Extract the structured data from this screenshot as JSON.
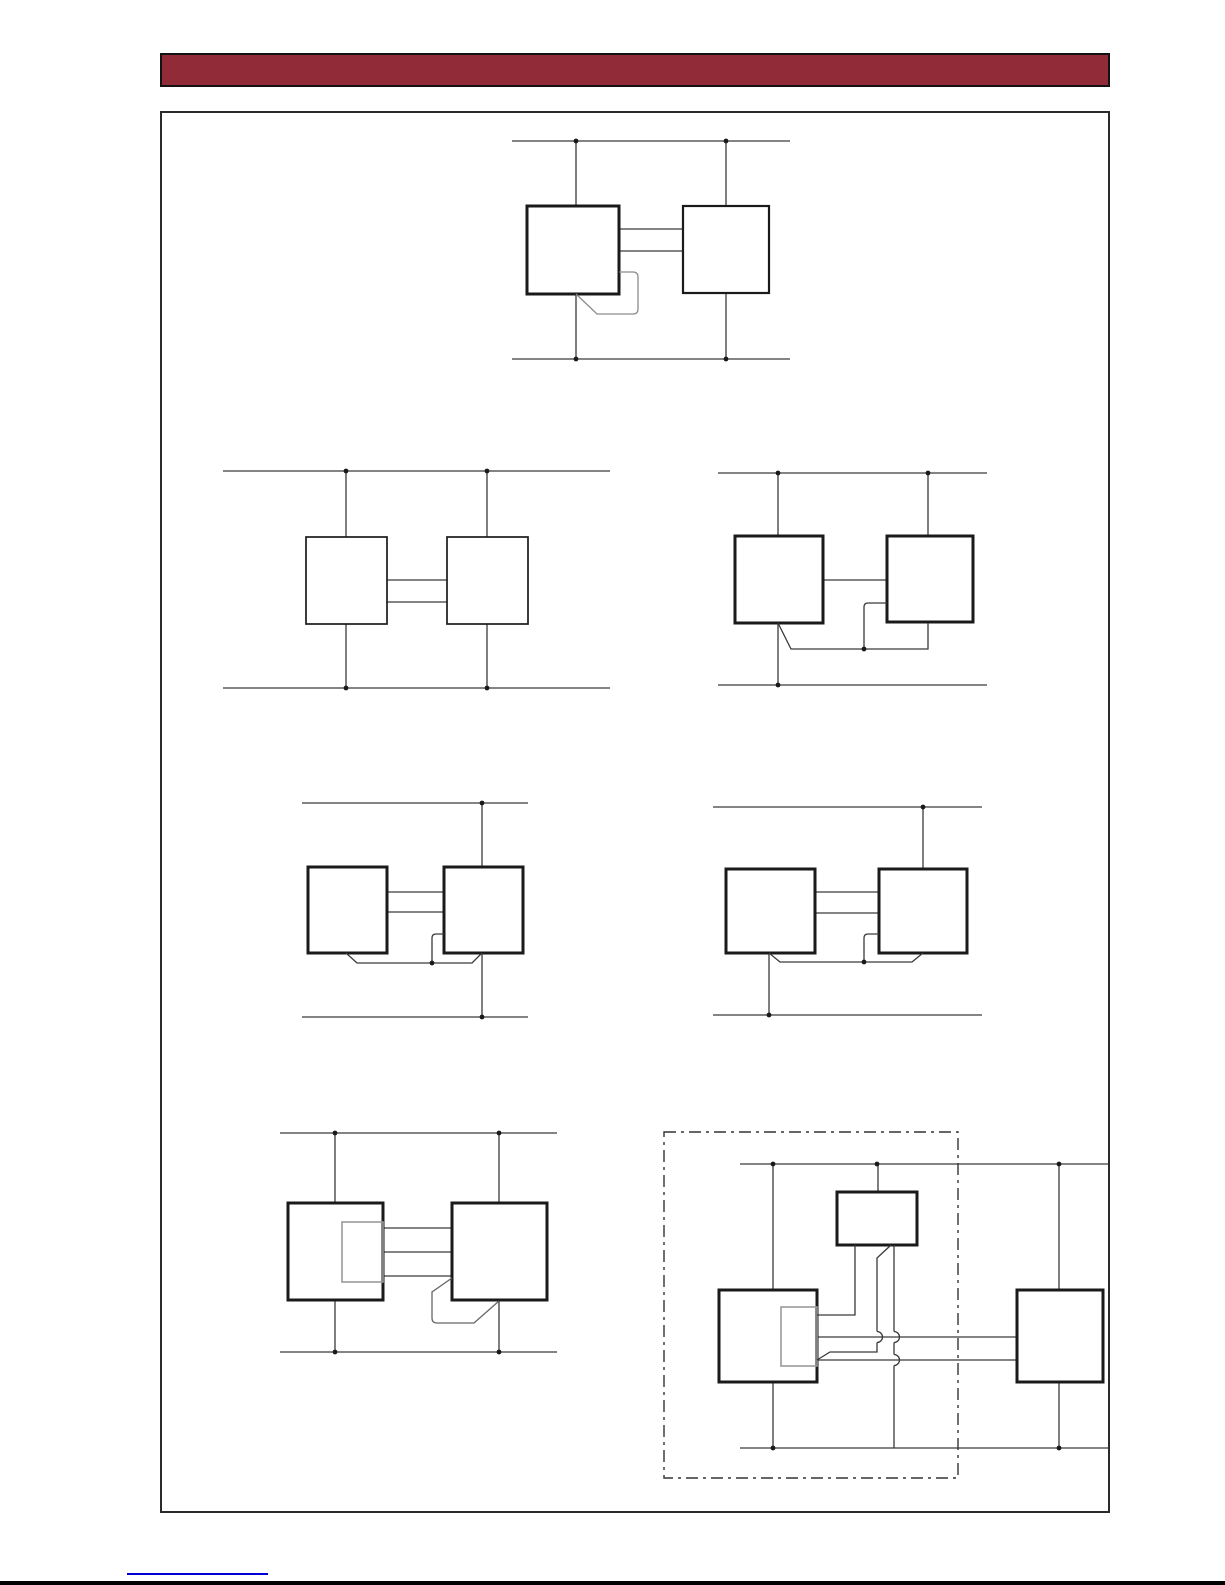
{
  "page": {
    "background": "#ffffff",
    "header_bar_color": "#922b38",
    "header_bar_border": "#131313",
    "frame_border": "#2b2b2b",
    "footer_link_color": "#0000d4",
    "bottom_edge_color": "#000000"
  },
  "diagram_styles": {
    "line_color": "#3a3a3a",
    "line_width": 1.3,
    "box_color": "#1a1a1a",
    "box_fill": "#ffffff",
    "inner_rect_color": "#9a9a9a",
    "dot_color": "#1a1a1a",
    "dot_radius": 2.4,
    "dash_color": "#333333",
    "dash_pattern": "12 5 3 5"
  },
  "diagrams": [
    {
      "name": "top-pair-with-loopback",
      "lines": [
        [
          512,
          141,
          790,
          141
        ],
        [
          512,
          359,
          790,
          359
        ],
        [
          576,
          141,
          576,
          206
        ],
        [
          726,
          141,
          726,
          206
        ],
        [
          576,
          294,
          576,
          359
        ],
        [
          726,
          293,
          726,
          359
        ],
        [
          619,
          229,
          683,
          229
        ],
        [
          619,
          251,
          683,
          251
        ]
      ],
      "boxes": [
        {
          "x": 527,
          "y": 206,
          "w": 92,
          "h": 88,
          "sw": 3
        },
        {
          "x": 683,
          "y": 206,
          "w": 86,
          "h": 87,
          "sw": 2.2
        }
      ],
      "paths": [
        {
          "d": "M619,272 L633,272 Q638,272 638,277 L638,309 Q638,314 633,314 L597,314 L576,294",
          "c": "#8c8c8c"
        }
      ],
      "dots": [
        [
          576,
          141
        ],
        [
          726,
          141
        ],
        [
          576,
          359
        ],
        [
          726,
          359
        ]
      ]
    },
    {
      "name": "pair-simple-bus",
      "lines": [
        [
          223,
          471,
          610,
          471
        ],
        [
          223,
          688,
          610,
          688
        ],
        [
          346,
          471,
          346,
          537
        ],
        [
          487,
          471,
          487,
          537
        ],
        [
          346,
          624,
          346,
          688
        ],
        [
          487,
          624,
          487,
          688
        ],
        [
          387,
          580,
          447,
          580
        ],
        [
          387,
          602,
          447,
          602
        ]
      ],
      "boxes": [
        {
          "x": 306,
          "y": 537,
          "w": 81,
          "h": 87,
          "sw": 1.7
        },
        {
          "x": 447,
          "y": 537,
          "w": 81,
          "h": 87,
          "sw": 1.7
        }
      ],
      "paths": [],
      "dots": [
        [
          346,
          471
        ],
        [
          487,
          471
        ],
        [
          346,
          688
        ],
        [
          487,
          688
        ]
      ]
    },
    {
      "name": "pair-shared-bottom-wire",
      "lines": [
        [
          718,
          473,
          987,
          473
        ],
        [
          718,
          685,
          987,
          685
        ],
        [
          778,
          473,
          778,
          536
        ],
        [
          928,
          473,
          928,
          536
        ],
        [
          778,
          623,
          778,
          685
        ],
        [
          823,
          580,
          887,
          580
        ]
      ],
      "boxes": [
        {
          "x": 735,
          "y": 536,
          "w": 88,
          "h": 87,
          "sw": 3
        },
        {
          "x": 887,
          "y": 536,
          "w": 86,
          "h": 86,
          "sw": 3
        }
      ],
      "paths": [
        {
          "d": "M778,623 L791,649 L928,649 L928,623"
        },
        {
          "d": "M887,603 L868,603 Q864,603 864,607 L864,649"
        }
      ],
      "dots": [
        [
          778,
          473
        ],
        [
          928,
          473
        ],
        [
          778,
          685
        ],
        [
          864,
          649
        ]
      ]
    },
    {
      "name": "pair-right-rail-only",
      "lines": [
        [
          302,
          803,
          528,
          803
        ],
        [
          302,
          1017,
          528,
          1017
        ],
        [
          482,
          803,
          482,
          867
        ],
        [
          482,
          953,
          482,
          1017
        ],
        [
          387,
          892,
          444,
          892
        ],
        [
          387,
          912,
          444,
          912
        ]
      ],
      "boxes": [
        {
          "x": 308,
          "y": 867,
          "w": 79,
          "h": 86,
          "sw": 3
        },
        {
          "x": 444,
          "y": 867,
          "w": 79,
          "h": 86,
          "sw": 3
        }
      ],
      "paths": [
        {
          "d": "M346,953 L357,963 L472,963 L482,953"
        },
        {
          "d": "M444,934 L436,934 Q432,934 432,938 L432,963"
        }
      ],
      "dots": [
        [
          482,
          803
        ],
        [
          482,
          1017
        ],
        [
          432,
          963
        ]
      ]
    },
    {
      "name": "pair-split-rails",
      "lines": [
        [
          713,
          807,
          982,
          807
        ],
        [
          713,
          1015,
          982,
          1015
        ],
        [
          923,
          807,
          923,
          869
        ],
        [
          769,
          953,
          769,
          1015
        ],
        [
          815,
          892,
          879,
          892
        ],
        [
          815,
          913,
          879,
          913
        ]
      ],
      "boxes": [
        {
          "x": 726,
          "y": 869,
          "w": 89,
          "h": 84,
          "sw": 3
        },
        {
          "x": 879,
          "y": 869,
          "w": 88,
          "h": 84,
          "sw": 3
        }
      ],
      "paths": [
        {
          "d": "M769,953 L780,962 L912,962 L923,953"
        },
        {
          "d": "M879,934 L868,934 Q864,934 864,938 L864,962"
        }
      ],
      "dots": [
        [
          923,
          807
        ],
        [
          769,
          1015
        ],
        [
          864,
          962
        ]
      ]
    },
    {
      "name": "pair-with-inner-block",
      "lines": [
        [
          280,
          1133,
          557,
          1133
        ],
        [
          280,
          1352,
          557,
          1352
        ],
        [
          335,
          1133,
          335,
          1203
        ],
        [
          499,
          1133,
          499,
          1203
        ],
        [
          335,
          1300,
          335,
          1352
        ],
        [
          499,
          1301,
          499,
          1352
        ],
        [
          383,
          1228,
          452,
          1228
        ],
        [
          383,
          1252,
          452,
          1252
        ],
        [
          383,
          1276,
          452,
          1276
        ]
      ],
      "boxes": [
        {
          "x": 288,
          "y": 1203,
          "w": 95,
          "h": 97,
          "sw": 3
        },
        {
          "x": 452,
          "y": 1203,
          "w": 95,
          "h": 97,
          "sw": 3
        }
      ],
      "inner_rects": [
        {
          "x": 342,
          "y": 1222,
          "w": 41,
          "h": 60
        }
      ],
      "paths": [
        {
          "d": "M452,1278 L432,1292 L432,1318 Q432,1323 437,1323 L474,1323 L499,1301",
          "c": "#666666"
        }
      ],
      "dots": [
        [
          335,
          1133
        ],
        [
          499,
          1133
        ],
        [
          335,
          1352
        ],
        [
          499,
          1352
        ]
      ]
    },
    {
      "name": "three-device-module",
      "dash_rects": [
        {
          "x": 664,
          "y": 1132,
          "w": 294,
          "h": 346
        }
      ],
      "lines": [
        [
          740,
          1164,
          1108,
          1164
        ],
        [
          740,
          1448,
          1108,
          1448
        ],
        [
          878,
          1164,
          878,
          1192
        ],
        [
          773,
          1164,
          773,
          1290
        ],
        [
          773,
          1382,
          773,
          1448
        ],
        [
          1059,
          1164,
          1059,
          1290
        ],
        [
          1059,
          1382,
          1059,
          1448
        ],
        [
          817,
          1337,
          1017,
          1337
        ],
        [
          817,
          1360,
          1017,
          1360
        ]
      ],
      "boxes": [
        {
          "x": 837,
          "y": 1192,
          "w": 80,
          "h": 53,
          "sw": 3
        },
        {
          "x": 719,
          "y": 1290,
          "w": 98,
          "h": 92,
          "sw": 3
        },
        {
          "x": 1017,
          "y": 1290,
          "w": 86,
          "h": 92,
          "sw": 3
        }
      ],
      "inner_rects": [
        {
          "x": 781,
          "y": 1307,
          "w": 36,
          "h": 59
        }
      ],
      "paths": [
        {
          "d": "M855,1245 L855,1315 L817,1315"
        },
        {
          "d": "M891,1245 L877,1258 L877,1331.5"
        },
        {
          "d": "M877,1331.5 A5.5,5.5 0 0 1 877,1342.5"
        },
        {
          "d": "M877,1342.5 L877,1352 L830,1352 L817,1360"
        },
        {
          "d": "M894,1245 L894,1331.5"
        },
        {
          "d": "M894,1331.5 A5.5,5.5 0 0 1 894,1342.5"
        },
        {
          "d": "M894,1342.5 L894,1354.5"
        },
        {
          "d": "M894,1354.5 A5.5,5.5 0 0 1 894,1365.5"
        },
        {
          "d": "M894,1365.5 L894,1448"
        }
      ],
      "dots": [
        [
          773,
          1164
        ],
        [
          877,
          1164
        ],
        [
          1059,
          1164
        ],
        [
          773,
          1448
        ],
        [
          1059,
          1448
        ]
      ]
    }
  ]
}
